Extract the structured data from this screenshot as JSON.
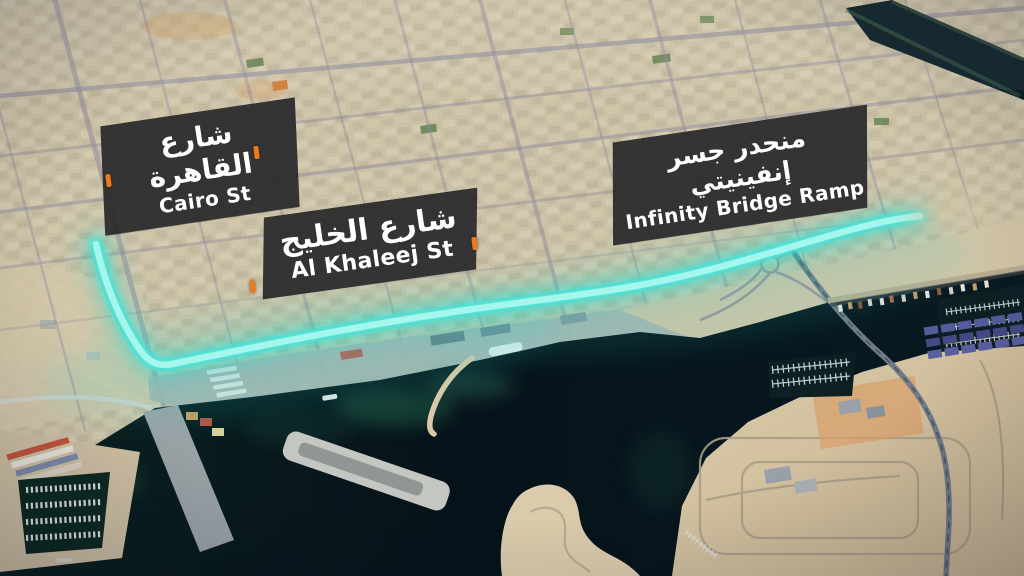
{
  "map_labels": {
    "cairo": {
      "arabic": "شارع القاهرة",
      "english": "Cairo St"
    },
    "khaleej": {
      "arabic": "شارع الخليج",
      "english": "Al Khaleej St"
    },
    "infinity": {
      "arabic": "منحدر جسر إنفينيتي",
      "english": "Infinity Bridge Ramp"
    }
  },
  "route": {
    "highlight_color": "#3de9da"
  },
  "markers": {
    "tick_color": "#ee7a1e",
    "tick_count": 4
  }
}
